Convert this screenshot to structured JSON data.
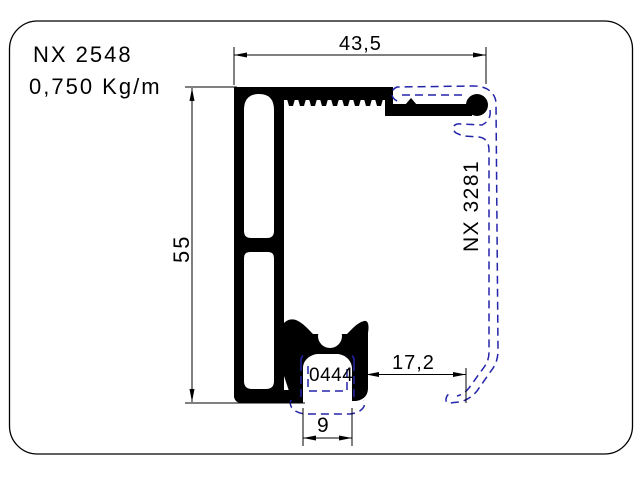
{
  "title": {
    "profile_code": "NX 2548",
    "weight": "0,750 Kg/m"
  },
  "labels": {
    "mating_profile": "NX 3281",
    "gasket_code": "0444"
  },
  "dimensions": {
    "top_width": "43,5",
    "left_height": "55",
    "right_gap": "17,2",
    "bottom_slot": "9"
  },
  "colors": {
    "line": "#000000",
    "dashed_profile": "#2424aa",
    "background": "#ffffff"
  }
}
